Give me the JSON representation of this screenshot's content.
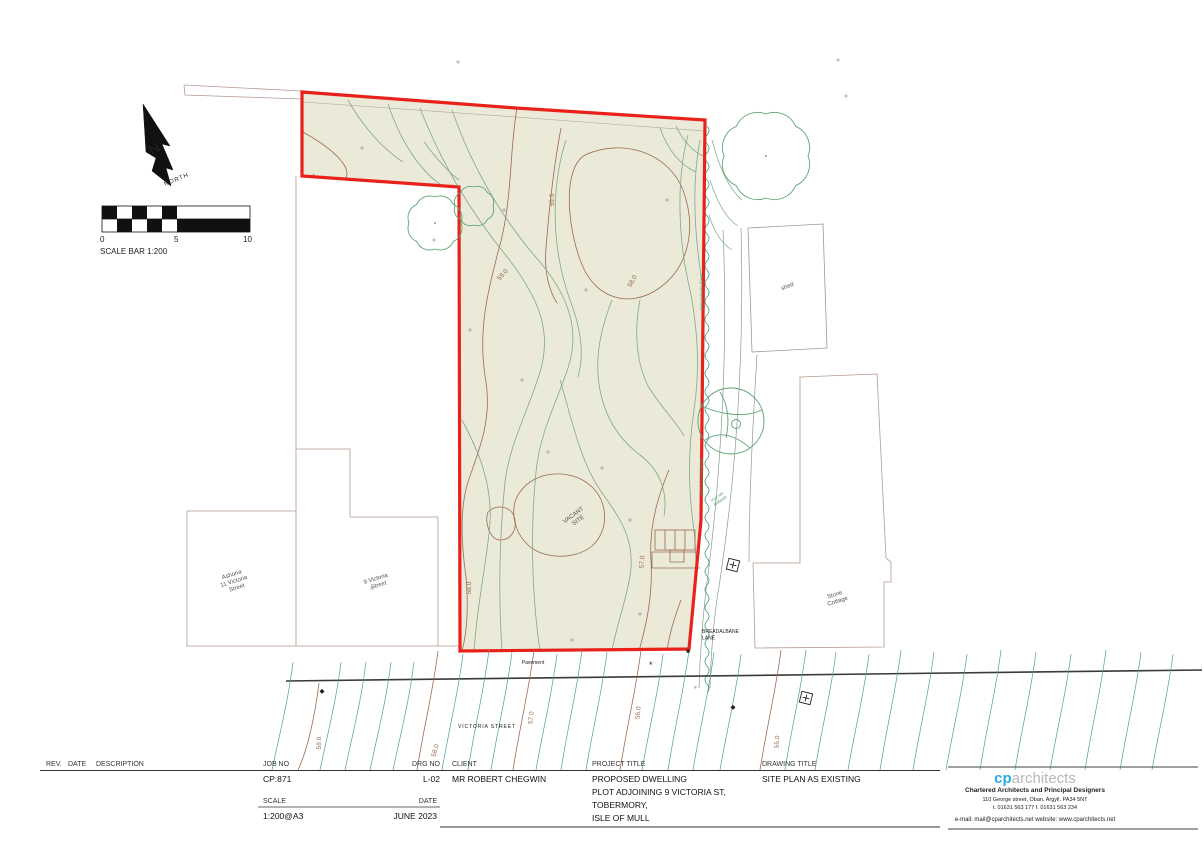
{
  "north_arrow": {
    "letter": "N",
    "label": "NORTH"
  },
  "scale_bar": {
    "tick_0": "0",
    "tick_5": "5",
    "tick_10": "10",
    "caption": "SCALE BAR 1:200"
  },
  "plan": {
    "vacant_site_line1": "VACANT",
    "vacant_site_line2": "SITE",
    "neighbor_left_line1": "Ashona",
    "neighbor_left_line2": "11 Victoria",
    "neighbor_left_line3": "Street",
    "neighbor_mid_line1": "9 Victoria",
    "neighbor_mid_line2": "Street",
    "shed": "shed",
    "stone_cottage_line1": "Stone",
    "stone_cottage_line2": "Cottage",
    "breadalbane_line1": "BREADALBANE",
    "breadalbane_line2": "LANE",
    "pavement": "Pavement",
    "victoria_street": "VICTORIA STREET",
    "fence_note": "post and wire fence",
    "hydrant_note_line1": "Hyd wtr",
    "hydrant_note_line2": "Bollards",
    "site_contour_labels": [
      "59.0",
      "59.0",
      "58.0",
      "58.0",
      "57.0"
    ],
    "street_contour_labels": [
      "59.0",
      "58.0",
      "57.0",
      "56.0",
      "55.0"
    ]
  },
  "title_block": {
    "rev_header": "REV.",
    "date_header": "DATE",
    "description_header": "DESCRIPTION",
    "job_no_label": "JOB NO",
    "job_no": "CP:871",
    "drg_no_label": "DRG NO",
    "drg_no": "L-02",
    "client_label": "CLIENT",
    "client": "MR ROBERT CHEGWIN",
    "project_title_label": "PROJECT TITLE",
    "project_title_line1": "PROPOSED DWELLING",
    "project_title_line2": "PLOT ADJOINING 9 VICTORIA ST,",
    "project_title_line3": "TOBERMORY,",
    "project_title_line4": "ISLE OF MULL",
    "drawing_title_label": "DRAWING TITLE",
    "drawing_title": "SITE PLAN AS EXISTING",
    "scale_label": "SCALE",
    "scale": "1:200@A3",
    "date_label": "DATE",
    "date": "JUNE 2023"
  },
  "logo": {
    "brand_cp": "cp",
    "brand_rest": "architects",
    "tagline": "Chartered Architects and Principal Designers",
    "address": "110 George street, Oban, Argyll.  PA34 5NT",
    "phone": "t. 01631 563 177 f. 01631 563 234",
    "contact": "e-mail: mail@cparchitects.net   website: www.cparchitects.net"
  },
  "colors": {
    "boundary": "#e8221a",
    "site_fill": "#ebe9d7",
    "contour_brown": "#9a6b50",
    "contour_green": "#7fa98c",
    "hedge_teal": "#3f9e8e",
    "street_teal": "#4e9e96",
    "neighbor_line": "#b49a90",
    "brand_blue": "#29abe2"
  }
}
